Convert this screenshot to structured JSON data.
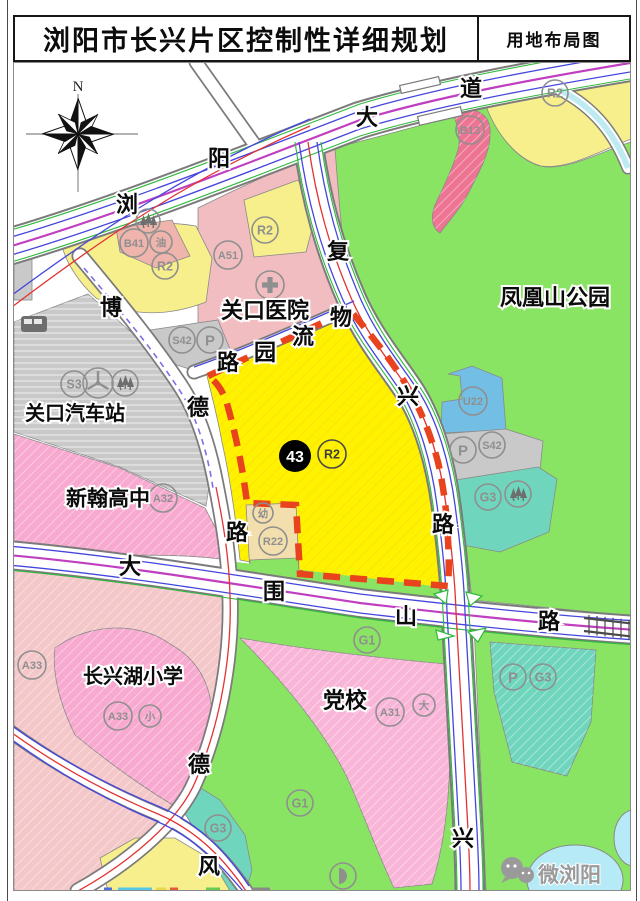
{
  "title_bar": {
    "title": "浏阳市长兴片区控制性详细规划",
    "map_type": "用地布局图"
  },
  "compass": {
    "north_label": "N"
  },
  "watermark": {
    "text": "微浏阳"
  },
  "legend_colors": {
    "residential_yellow": "#fff200",
    "residential_yellow_pale": "#f7ef8c",
    "commercial_pink": "#ee7493",
    "gas_station_salmon": "#efb4ab",
    "hospital_pink": "#f2bdc0",
    "school_pink": "#f8a9cf",
    "party_school_pink": "#f9b5d8",
    "pale_salmon": "#f4c7c9",
    "facility_gray": "#c9c9c9",
    "green_space": "#8ae463",
    "protection_teal": "#6fd6bd",
    "utility_blue": "#72bee4",
    "kindergarten_tan": "#f3dfae",
    "water_blue": "#b7eaf7",
    "plot_boundary_red": "#e8431c"
  },
  "map": {
    "parcel_badge": {
      "number": "43",
      "zone": "R2",
      "x": 295,
      "y": 456,
      "r": 16
    },
    "place_labels": [
      {
        "text": "关口医院",
        "x": 265,
        "y": 310,
        "size": 22
      },
      {
        "text": "凤凰山公园",
        "x": 555,
        "y": 297,
        "size": 22
      },
      {
        "text": "关口汽车站",
        "x": 75,
        "y": 413,
        "size": 20
      },
      {
        "text": "新翰高中",
        "x": 108,
        "y": 498,
        "size": 21
      },
      {
        "text": "长兴湖小学",
        "x": 133,
        "y": 676,
        "size": 20
      },
      {
        "text": "党校",
        "x": 345,
        "y": 700,
        "size": 22
      }
    ],
    "road_labels": [
      {
        "ch": "浏",
        "x": 127,
        "y": 204
      },
      {
        "ch": "阳",
        "x": 219,
        "y": 158
      },
      {
        "ch": "大",
        "x": 367,
        "y": 117
      },
      {
        "ch": "道",
        "x": 471,
        "y": 88
      },
      {
        "ch": "复",
        "x": 338,
        "y": 251
      },
      {
        "ch": "物",
        "x": 341,
        "y": 317
      },
      {
        "ch": "流",
        "x": 303,
        "y": 336
      },
      {
        "ch": "园",
        "x": 265,
        "y": 352
      },
      {
        "ch": "路",
        "x": 228,
        "y": 362
      },
      {
        "ch": "博",
        "x": 111,
        "y": 307
      },
      {
        "ch": "德",
        "x": 198,
        "y": 407
      },
      {
        "ch": "路",
        "x": 237,
        "y": 532
      },
      {
        "ch": "兴",
        "x": 408,
        "y": 396
      },
      {
        "ch": "路",
        "x": 443,
        "y": 524
      },
      {
        "ch": "大",
        "x": 130,
        "y": 566
      },
      {
        "ch": "围",
        "x": 274,
        "y": 591
      },
      {
        "ch": "山",
        "x": 406,
        "y": 616
      },
      {
        "ch": "路",
        "x": 549,
        "y": 621
      },
      {
        "ch": "德",
        "x": 199,
        "y": 764
      },
      {
        "ch": "风",
        "x": 209,
        "y": 866
      },
      {
        "ch": "兴",
        "x": 463,
        "y": 838
      }
    ],
    "zone_circles": [
      {
        "kind": "trees",
        "x": 148,
        "y": 221,
        "r": 12
      },
      {
        "kind": "code",
        "code": "B41",
        "x": 134,
        "y": 243,
        "r": 14
      },
      {
        "kind": "code",
        "code": "油",
        "x": 161,
        "y": 242,
        "r": 11
      },
      {
        "kind": "code",
        "code": "R2",
        "x": 165,
        "y": 266,
        "r": 13
      },
      {
        "kind": "code",
        "code": "R2",
        "x": 265,
        "y": 230,
        "r": 13
      },
      {
        "kind": "code",
        "code": "A51",
        "x": 228,
        "y": 255,
        "r": 14
      },
      {
        "kind": "cross",
        "x": 270,
        "y": 285,
        "r": 14
      },
      {
        "kind": "code",
        "code": "R2",
        "x": 555,
        "y": 93,
        "r": 13
      },
      {
        "kind": "code",
        "code": "B13",
        "x": 470,
        "y": 130,
        "r": 14
      },
      {
        "kind": "code",
        "code": "S42",
        "x": 182,
        "y": 340,
        "r": 13
      },
      {
        "kind": "P",
        "x": 210,
        "y": 340,
        "r": 13
      },
      {
        "kind": "bus",
        "x": 34,
        "y": 324
      },
      {
        "kind": "code",
        "code": "S3",
        "x": 74,
        "y": 384,
        "r": 13
      },
      {
        "kind": "star",
        "x": 98,
        "y": 383,
        "r": 15
      },
      {
        "kind": "trees",
        "x": 125,
        "y": 383,
        "r": 13
      },
      {
        "kind": "code",
        "code": "A32",
        "x": 163,
        "y": 498,
        "r": 14
      },
      {
        "kind": "code",
        "code": "R2",
        "x": 332,
        "y": 454,
        "r": 14,
        "variant": "dark"
      },
      {
        "kind": "code",
        "code": "幼",
        "x": 263,
        "y": 513,
        "r": 10
      },
      {
        "kind": "code",
        "code": "R22",
        "x": 273,
        "y": 541,
        "r": 14
      },
      {
        "kind": "code",
        "code": "U22",
        "x": 473,
        "y": 401,
        "r": 14
      },
      {
        "kind": "P",
        "x": 463,
        "y": 450,
        "r": 13
      },
      {
        "kind": "code",
        "code": "S42",
        "x": 492,
        "y": 445,
        "r": 13
      },
      {
        "kind": "code",
        "code": "G3",
        "x": 488,
        "y": 497,
        "r": 13
      },
      {
        "kind": "trees",
        "x": 518,
        "y": 494,
        "r": 13
      },
      {
        "kind": "code",
        "code": "A33",
        "x": 32,
        "y": 665,
        "r": 14
      },
      {
        "kind": "code",
        "code": "A33",
        "x": 118,
        "y": 716,
        "r": 14
      },
      {
        "kind": "code",
        "code": "小",
        "x": 150,
        "y": 716,
        "r": 11
      },
      {
        "kind": "code",
        "code": "G1",
        "x": 367,
        "y": 640,
        "r": 13
      },
      {
        "kind": "code",
        "code": "A31",
        "x": 390,
        "y": 712,
        "r": 14
      },
      {
        "kind": "code",
        "code": "大",
        "x": 424,
        "y": 705,
        "r": 11
      },
      {
        "kind": "P",
        "x": 513,
        "y": 677,
        "r": 13
      },
      {
        "kind": "code",
        "code": "G3",
        "x": 543,
        "y": 677,
        "r": 13
      },
      {
        "kind": "code",
        "code": "G3",
        "x": 218,
        "y": 828,
        "r": 13
      },
      {
        "kind": "code",
        "code": "G1",
        "x": 300,
        "y": 803,
        "r": 13
      },
      {
        "kind": "park",
        "x": 343,
        "y": 876,
        "r": 13
      }
    ],
    "bottom_edge_marks": [
      {
        "color": "#4a6fe0",
        "x": 104,
        "w": 8
      },
      {
        "color": "#55c8e8",
        "x": 118,
        "w": 34
      },
      {
        "color": "#e8d84a",
        "x": 156,
        "w": 10
      },
      {
        "color": "#e85a3a",
        "x": 170,
        "w": 8
      },
      {
        "color": "#66cc55",
        "x": 206,
        "w": 14
      },
      {
        "color": "#8a8a8a",
        "x": 252,
        "w": 18
      }
    ]
  }
}
